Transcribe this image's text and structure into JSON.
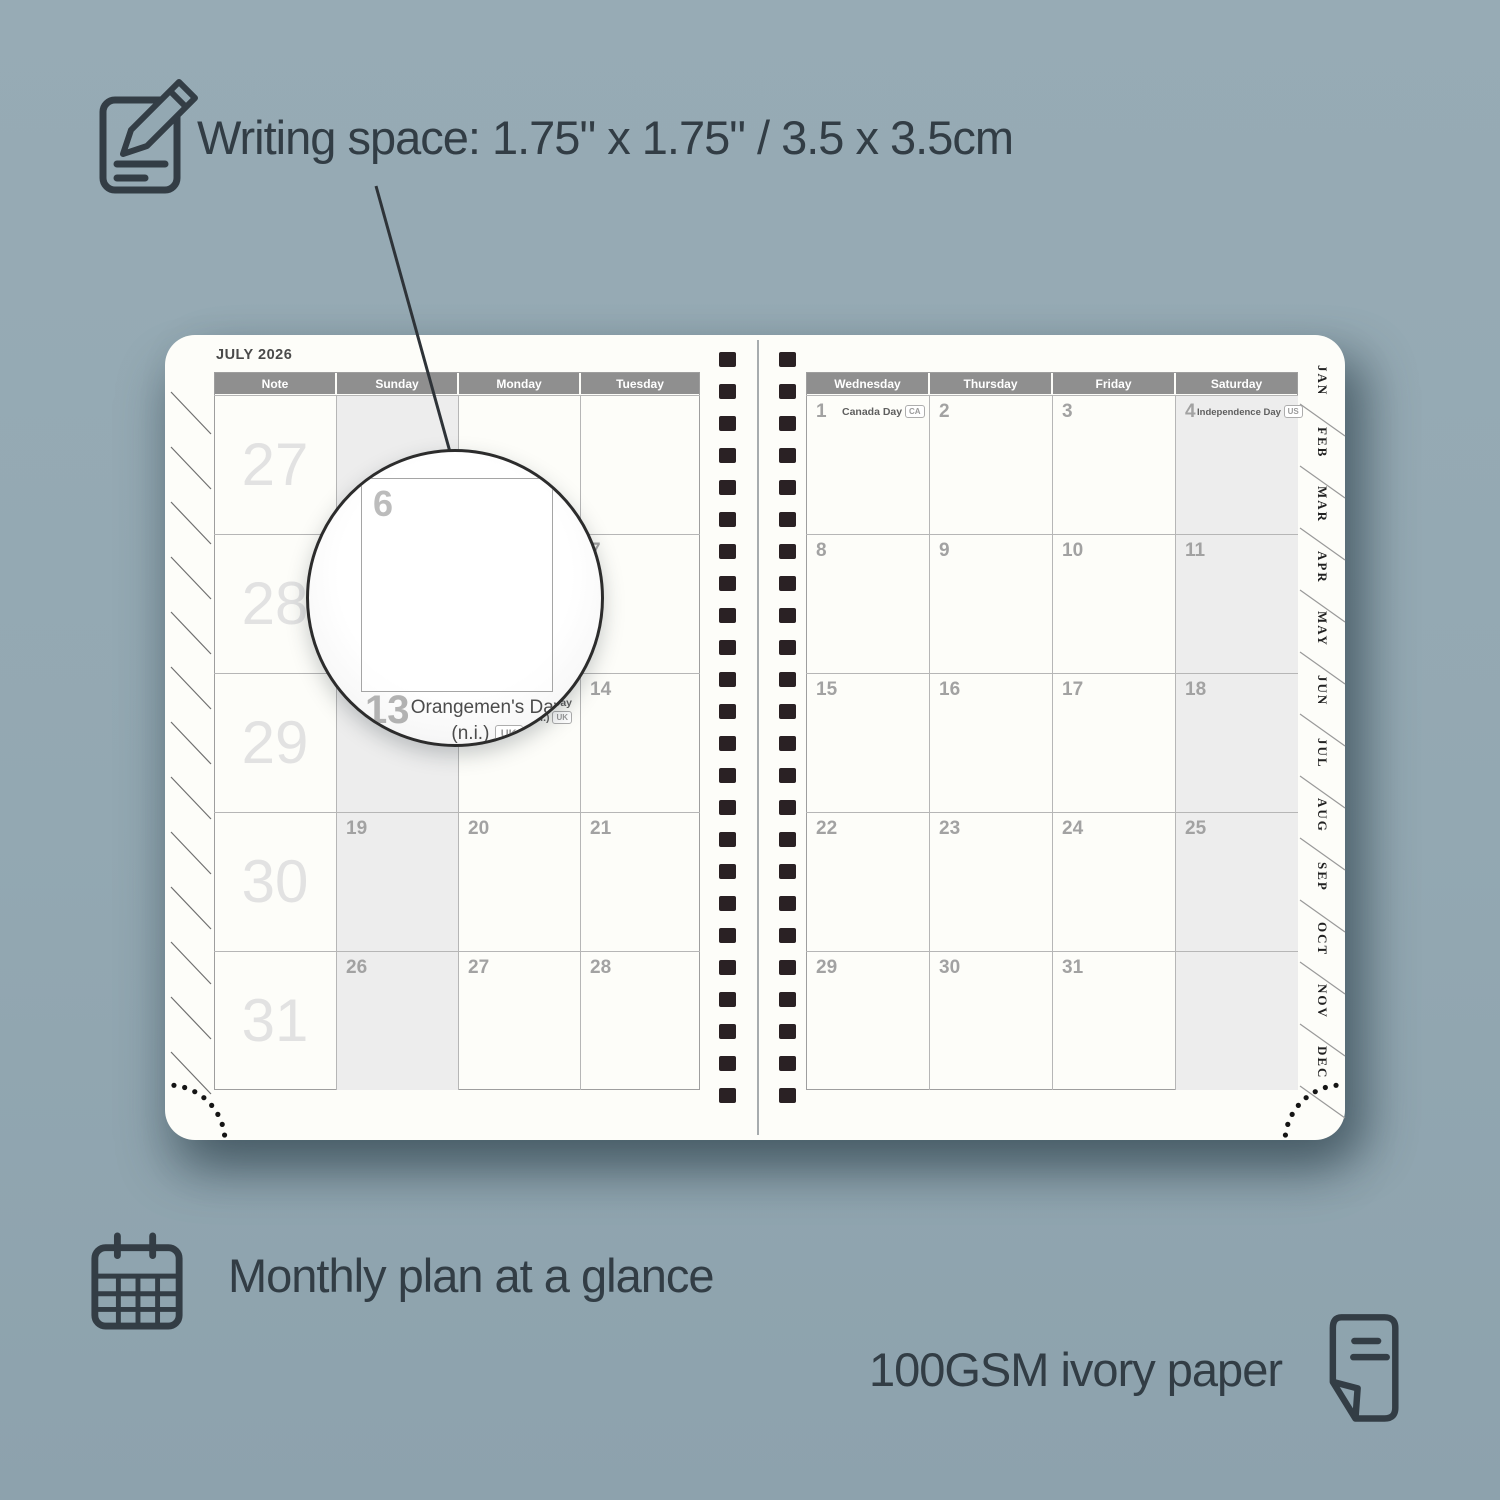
{
  "colors": {
    "background": "#93a8b2",
    "caption_text": "#323d45",
    "page": "#fdfdf9",
    "header_band": "#8f8f8f",
    "shaded_column": "#ededed",
    "week_number": "#e2e2e2",
    "day_number": "#a2a2a2",
    "binding_hole": "#2a2124"
  },
  "captions": {
    "writing_space": "Writing space: 1.75\" x 1.75\" / 3.5 x 3.5cm",
    "monthly_plan": "Monthly plan at a glance",
    "paper": "100GSM ivory paper"
  },
  "planner": {
    "title": "JULY 2026",
    "left_day_headers": [
      "Note",
      "Sunday",
      "Monday",
      "Tuesday"
    ],
    "right_day_headers": [
      "Wednesday",
      "Thursday",
      "Friday",
      "Saturday"
    ],
    "week_numbers": [
      "27",
      "28",
      "29",
      "30",
      "31"
    ],
    "left_days": [
      [
        "",
        "",
        ""
      ],
      [
        "5",
        "6",
        "7"
      ],
      [
        "12",
        "13",
        "14"
      ],
      [
        "19",
        "20",
        "21"
      ],
      [
        "26",
        "27",
        "28"
      ]
    ],
    "right_days": [
      [
        "1",
        "2",
        "3",
        "4"
      ],
      [
        "8",
        "9",
        "10",
        "11"
      ],
      [
        "15",
        "16",
        "17",
        "18"
      ],
      [
        "22",
        "23",
        "24",
        "25"
      ],
      [
        "29",
        "30",
        "31",
        ""
      ]
    ],
    "holidays": [
      {
        "day": "1",
        "name": "Canada Day",
        "badge": "CA"
      },
      {
        "day": "4",
        "name": "Independence Day",
        "badge": "US"
      },
      {
        "day": "13",
        "name": "Orangemen's Day",
        "name2": "(n.i.)",
        "badge": "UK"
      }
    ],
    "month_tabs": [
      "JAN",
      "FEB",
      "MAR",
      "APR",
      "MAY",
      "JUN",
      "JUL",
      "AUG",
      "SEP",
      "OCT",
      "NOV",
      "DEC"
    ]
  },
  "magnifier": {
    "day_in_view": "6",
    "day_below": "13",
    "holiday_line1": "Orangemen's Day",
    "holiday_line2": "(n.i.)",
    "holiday_badge": "UK"
  }
}
